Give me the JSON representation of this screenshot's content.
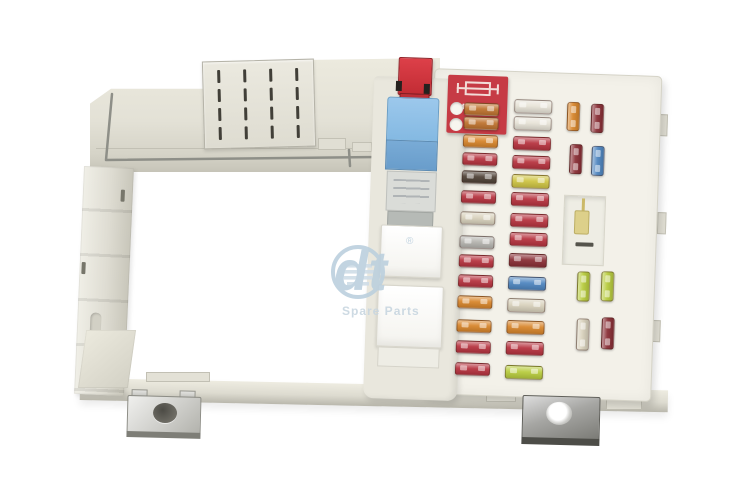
{
  "product": {
    "description": "Automotive fuse box with fuses and relays, product photo"
  },
  "label": {
    "text": "MAX 10A",
    "icon": "fuse-symbol",
    "background": "#c63b45"
  },
  "watermark": {
    "brand": "dt",
    "registered": "®",
    "subtitle": "Spare Parts",
    "color": "#bcd0de"
  },
  "colors": {
    "background": "#ffffff",
    "plastic": "#e4e2d8",
    "plastic_dark": "#c9c7bb",
    "panel": "#f3f1e9",
    "label_red": "#c63b45",
    "relay_blue": "#8cbfe6",
    "puller_red": "#cf3138",
    "fuses": {
      "red": "#b73440",
      "maroon": "#8a2f36",
      "orange": "#d8862c",
      "amber": "#bf7430",
      "brown": "#4f4237",
      "yellow": "#cfc544",
      "yellowgreen": "#b8cc3e",
      "blue": "#4f86c0",
      "tan": "#d9d2bd",
      "white": "#e7e3d7",
      "silver": "#b6b5b0"
    }
  },
  "vent": {
    "cols": 4,
    "rows": 4
  },
  "fuse_panel": {
    "fuses": [
      {
        "x": 93,
        "y": 17,
        "w": 35,
        "h": 13,
        "o": "h",
        "color": "amber"
      },
      {
        "x": 93,
        "y": 31,
        "w": 35,
        "h": 13,
        "o": "h",
        "color": "amber"
      },
      {
        "x": 93,
        "y": 49,
        "w": 35,
        "h": 13,
        "o": "h",
        "color": "orange"
      },
      {
        "x": 93,
        "y": 67,
        "w": 35,
        "h": 13,
        "o": "h",
        "color": "red"
      },
      {
        "x": 93,
        "y": 85,
        "w": 35,
        "h": 13,
        "o": "h",
        "color": "brown"
      },
      {
        "x": 93,
        "y": 105,
        "w": 35,
        "h": 13,
        "o": "h",
        "color": "red"
      },
      {
        "x": 93,
        "y": 126,
        "w": 35,
        "h": 13,
        "o": "h",
        "color": "tan"
      },
      {
        "x": 93,
        "y": 150,
        "w": 35,
        "h": 13,
        "o": "h",
        "color": "silver"
      },
      {
        "x": 93,
        "y": 169,
        "w": 35,
        "h": 13,
        "o": "h",
        "color": "red"
      },
      {
        "x": 93,
        "y": 189,
        "w": 35,
        "h": 13,
        "o": "h",
        "color": "red"
      },
      {
        "x": 93,
        "y": 210,
        "w": 35,
        "h": 13,
        "o": "h",
        "color": "orange"
      },
      {
        "x": 93,
        "y": 234,
        "w": 35,
        "h": 13,
        "o": "h",
        "color": "orange"
      },
      {
        "x": 93,
        "y": 255,
        "w": 35,
        "h": 13,
        "o": "h",
        "color": "red"
      },
      {
        "x": 93,
        "y": 277,
        "w": 35,
        "h": 13,
        "o": "h",
        "color": "red"
      },
      {
        "x": 143,
        "y": 12,
        "w": 38,
        "h": 14,
        "o": "h",
        "color": "white"
      },
      {
        "x": 143,
        "y": 29,
        "w": 38,
        "h": 14,
        "o": "h",
        "color": "white"
      },
      {
        "x": 143,
        "y": 49,
        "w": 38,
        "h": 14,
        "o": "h",
        "color": "red"
      },
      {
        "x": 143,
        "y": 68,
        "w": 38,
        "h": 14,
        "o": "h",
        "color": "red"
      },
      {
        "x": 143,
        "y": 87,
        "w": 38,
        "h": 14,
        "o": "h",
        "color": "yellow"
      },
      {
        "x": 143,
        "y": 105,
        "w": 38,
        "h": 14,
        "o": "h",
        "color": "red"
      },
      {
        "x": 143,
        "y": 126,
        "w": 38,
        "h": 14,
        "o": "h",
        "color": "red"
      },
      {
        "x": 143,
        "y": 145,
        "w": 38,
        "h": 14,
        "o": "h",
        "color": "red"
      },
      {
        "x": 143,
        "y": 166,
        "w": 38,
        "h": 14,
        "o": "h",
        "color": "maroon"
      },
      {
        "x": 143,
        "y": 189,
        "w": 38,
        "h": 14,
        "o": "h",
        "color": "blue"
      },
      {
        "x": 143,
        "y": 211,
        "w": 38,
        "h": 14,
        "o": "h",
        "color": "tan"
      },
      {
        "x": 143,
        "y": 233,
        "w": 38,
        "h": 14,
        "o": "h",
        "color": "orange"
      },
      {
        "x": 143,
        "y": 254,
        "w": 38,
        "h": 14,
        "o": "h",
        "color": "red"
      },
      {
        "x": 143,
        "y": 278,
        "w": 38,
        "h": 14,
        "o": "h",
        "color": "yellowgreen"
      },
      {
        "x": 196,
        "y": 13,
        "w": 13,
        "h": 29,
        "o": "v",
        "color": "orange"
      },
      {
        "x": 220,
        "y": 14,
        "w": 13,
        "h": 29,
        "o": "v",
        "color": "maroon"
      },
      {
        "x": 200,
        "y": 55,
        "w": 13,
        "h": 30,
        "o": "v",
        "color": "maroon"
      },
      {
        "x": 222,
        "y": 56,
        "w": 13,
        "h": 30,
        "o": "v",
        "color": "blue"
      },
      {
        "x": 212,
        "y": 182,
        "w": 13,
        "h": 30,
        "o": "v",
        "color": "yellowgreen"
      },
      {
        "x": 236,
        "y": 181,
        "w": 13,
        "h": 30,
        "o": "v",
        "color": "yellowgreen"
      },
      {
        "x": 213,
        "y": 229,
        "w": 13,
        "h": 32,
        "o": "v",
        "color": "tan"
      },
      {
        "x": 238,
        "y": 227,
        "w": 13,
        "h": 32,
        "o": "v",
        "color": "maroon"
      }
    ]
  }
}
